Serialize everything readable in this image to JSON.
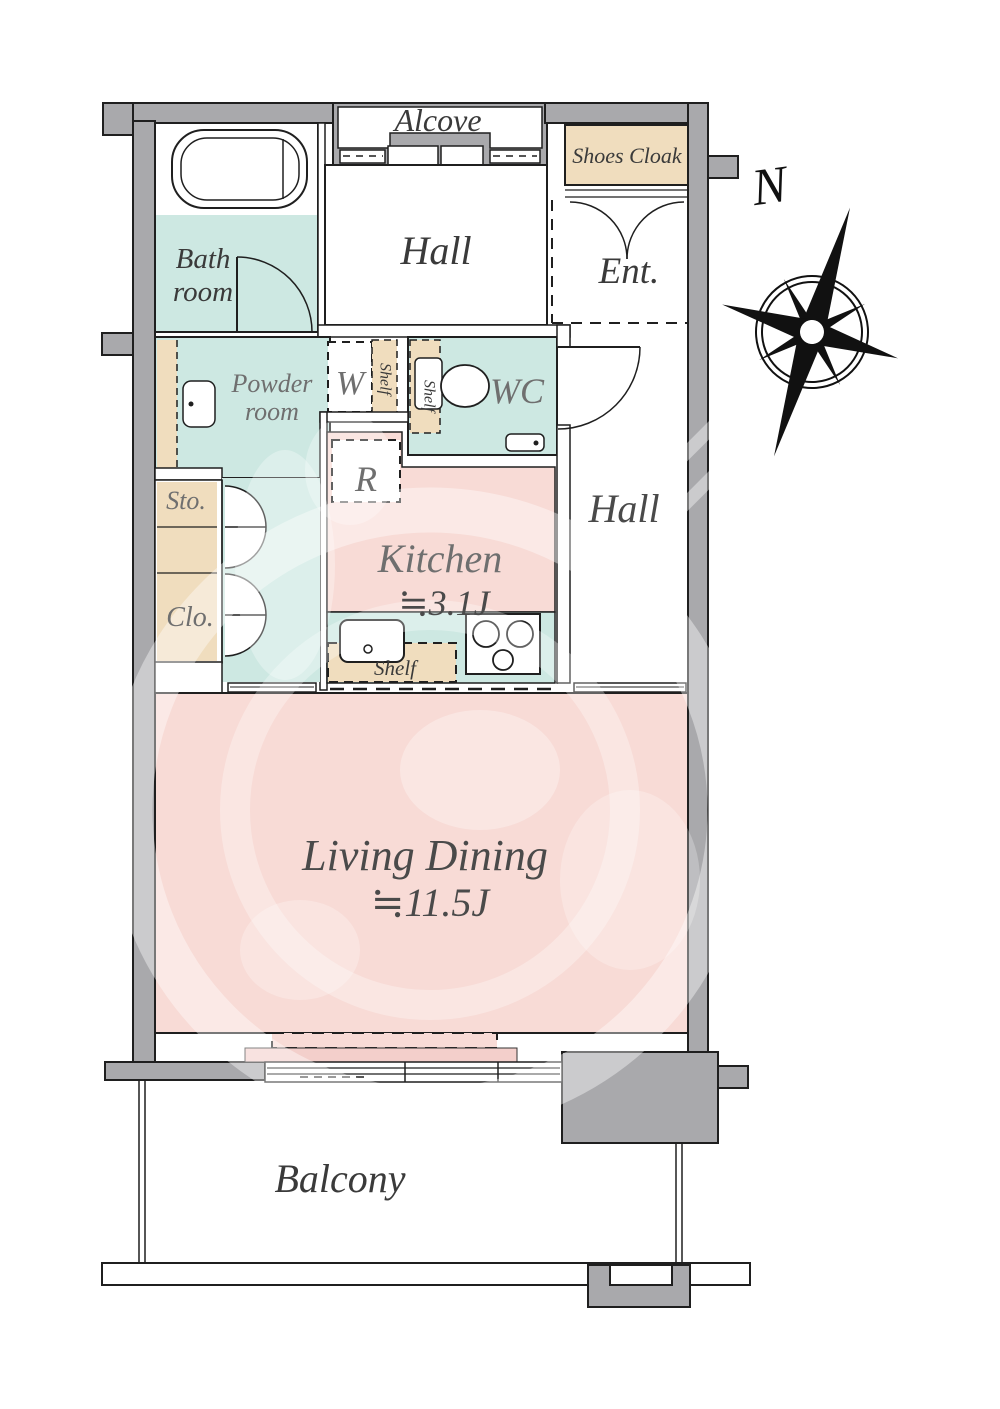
{
  "plan": {
    "compass": {
      "north_label": "N"
    },
    "rooms": {
      "alcove": {
        "label": "Alcove"
      },
      "shoes_cloak": {
        "label": "Shoes Cloak"
      },
      "entry_hall": {
        "label": "Hall"
      },
      "entrance": {
        "label": "Ent."
      },
      "bathroom": {
        "line1": "Bath",
        "line2": "room"
      },
      "powder_room": {
        "line1": "Powder",
        "line2": "room"
      },
      "washer": {
        "label": "W"
      },
      "toilet_room": {
        "label": "WC"
      },
      "refrigerator": {
        "label": "R"
      },
      "kitchen": {
        "label": "Kitchen",
        "size": "≒3.1J"
      },
      "inner_hall": {
        "label": "Hall"
      },
      "storage": {
        "label": "Sto."
      },
      "closet": {
        "label": "Clo."
      },
      "living_dining": {
        "label": "Living Dining",
        "size": "≒11.5J"
      },
      "balcony": {
        "label": "Balcony"
      }
    },
    "fixtures": {
      "shelf_powder": {
        "label": "Shelf"
      },
      "shelf_wc": {
        "label": "Shelf"
      },
      "shelf_kitchen": {
        "label": "Shelf"
      }
    },
    "colors": {
      "wall_gray": "#a9a9ac",
      "floor_teal": "#cde8e2",
      "floor_pink": "#f8dbd6",
      "sill_pink": "#f3cfcb",
      "storage_beige": "#f0ddbe",
      "line_black": "#1f1f1f",
      "label_dark": "#3a3a3a",
      "label_gray": "#6f6f6f"
    }
  }
}
